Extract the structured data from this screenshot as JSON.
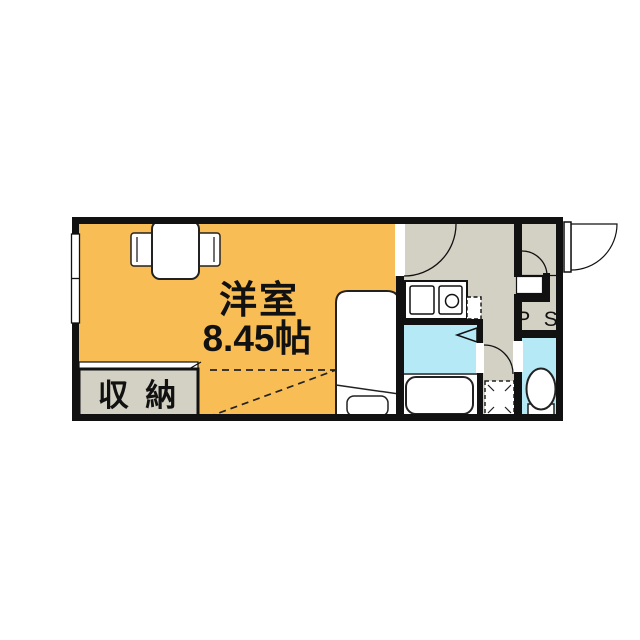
{
  "floorplan": {
    "title": "apartment-floor-plan",
    "labels": {
      "room_name": "洋室",
      "room_size": "8.45帖",
      "closet": "収 納",
      "pipe_space": "P S"
    },
    "colors": {
      "western_room": "#F8BD55",
      "hall_kitchen": "#D3D0C4",
      "wet_area": "#B5E9F6",
      "wall": "#111111",
      "fixture_fill": "#FFFFFF"
    },
    "fixtures": {
      "table": "dining-table",
      "chairs": "2",
      "bed": "single-bed",
      "kitchen": "sink-and-burner-counter",
      "bath": "bathtub",
      "toilet": "toilet",
      "washer_space": "dashed-square",
      "fridge_space": "dashed-square"
    }
  }
}
